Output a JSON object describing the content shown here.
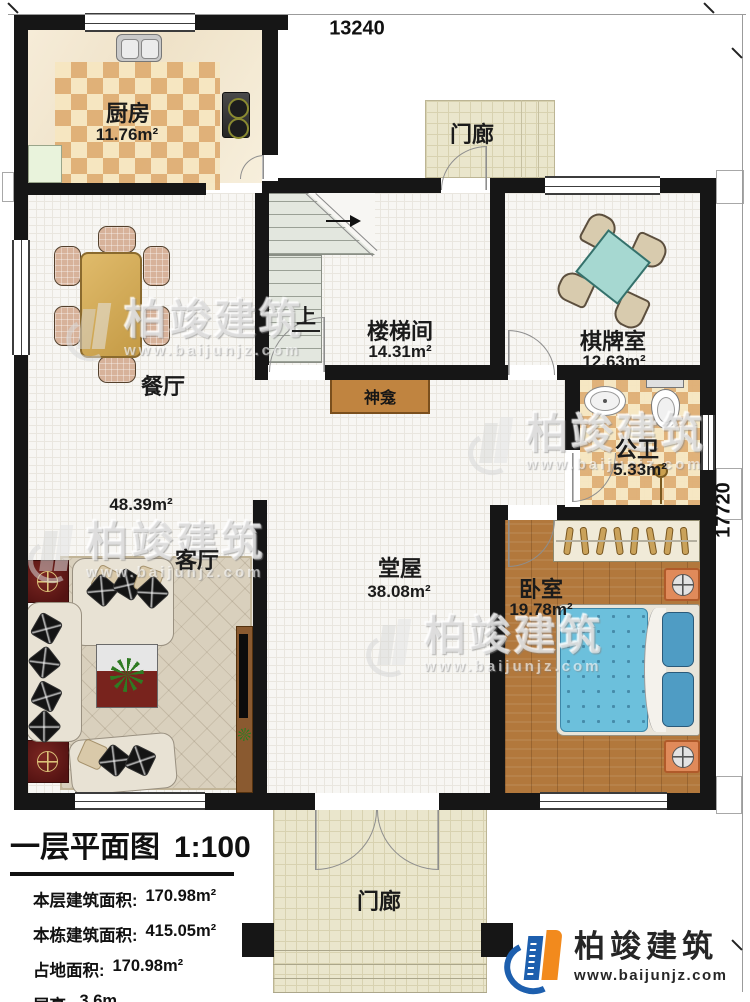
{
  "dimensions": {
    "width_label": "13240",
    "height_label": "17720"
  },
  "rooms": {
    "kitchen": {
      "name": "厨房",
      "area": "11.76m²"
    },
    "top_porch": {
      "name": "门廊"
    },
    "dining": {
      "name": "餐厅"
    },
    "stairwell": {
      "name": "楼梯间",
      "area": "14.31m²",
      "up_label": "上"
    },
    "game_room": {
      "name": "棋牌室",
      "area": "12.63m²"
    },
    "bathroom": {
      "name": "公卫",
      "area": "5.33m²"
    },
    "shrine": {
      "name": "神龛"
    },
    "hall": {
      "name": "堂屋",
      "area": "38.08m²"
    },
    "living_room": {
      "name": "客厅",
      "area": "48.39m²"
    },
    "bedroom": {
      "name": "卧室",
      "area": "19.78m²"
    },
    "bottom_porch": {
      "name": "门廊"
    }
  },
  "title_block": {
    "title": "一层平面图",
    "scale": "1:100",
    "info_lines": [
      {
        "label": "本层建筑面积:",
        "value": "170.98m²"
      },
      {
        "label": "本栋建筑面积:",
        "value": "415.05m²"
      },
      {
        "label": "占地面积:",
        "value": "170.98m²"
      },
      {
        "label": "层高:",
        "value": "3.6m"
      }
    ]
  },
  "brand": {
    "name": "柏竣建筑",
    "website": "www.baijunjz.com"
  },
  "watermark": {
    "name": "柏竣建筑",
    "website": "www.baijunjz.com"
  },
  "colors": {
    "wall": "#161616",
    "kitchen_tile": "#dfae74",
    "wood_floor": "#b2783c",
    "bed_teal": "#6cc0dc",
    "game_table": "#a6d8d1",
    "brand_blue": "#1d5fae",
    "brand_orange": "#f28a1d",
    "porch_tile": "#eae6cc"
  }
}
